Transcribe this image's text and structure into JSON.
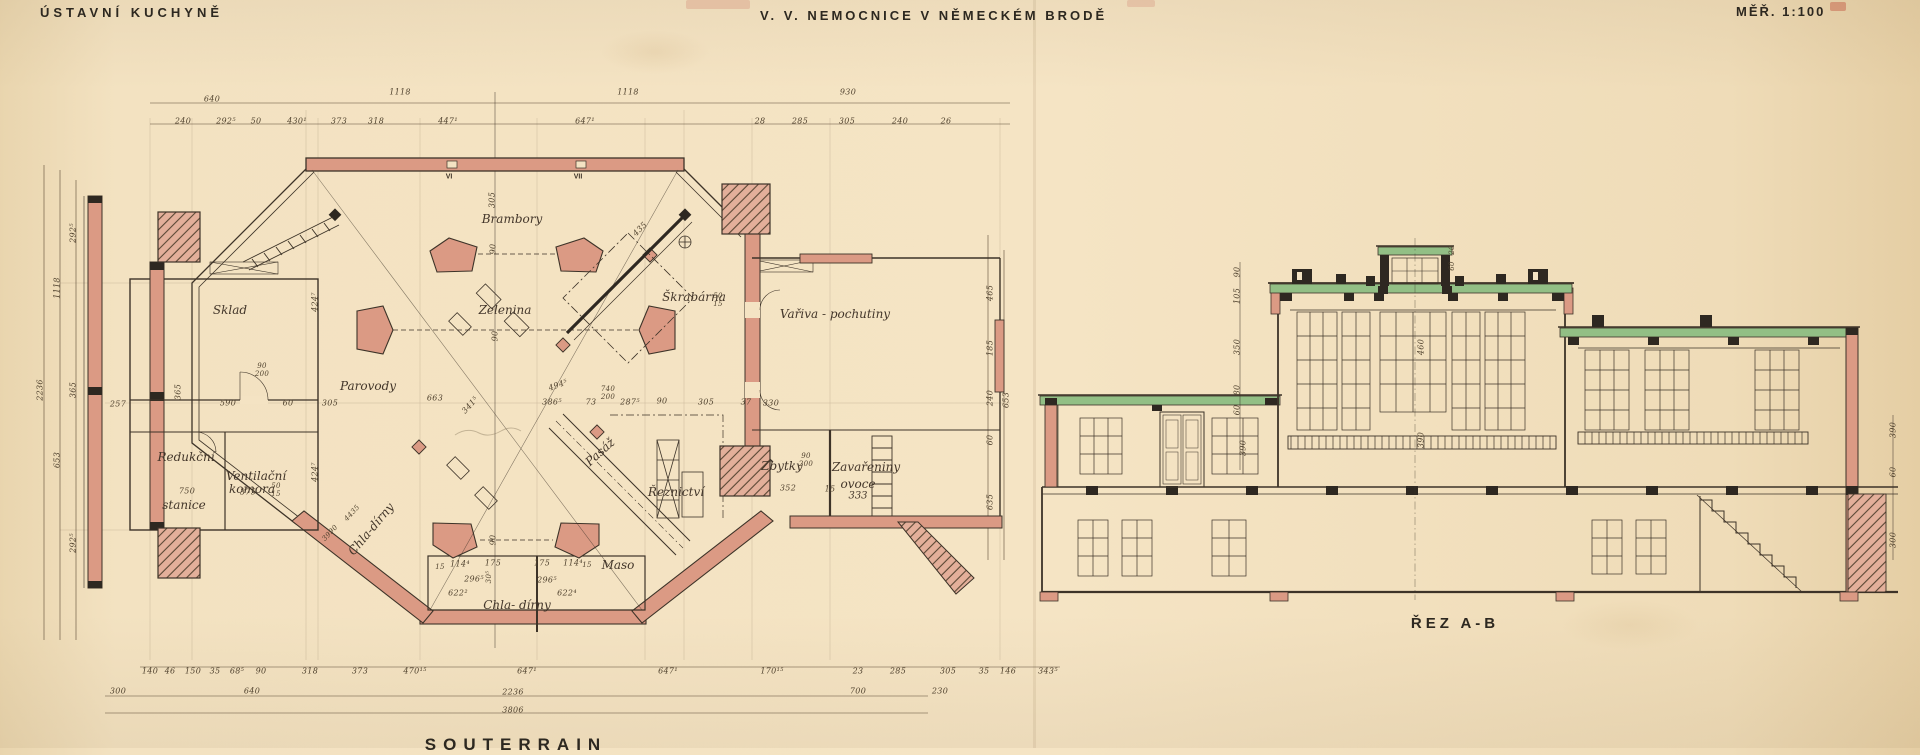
{
  "titles": {
    "left": "ÚSTAVNÍ KUCHYNĚ",
    "center": "V. V. NEMOCNICE V NĚMECKÉM BRODĚ",
    "right": "MĚŘ. 1:100"
  },
  "plan": {
    "caption": "SOUTERRAIN",
    "room_labels": [
      {
        "t": "Brambory",
        "x": 512,
        "y": 219
      },
      {
        "t": "Sklad",
        "x": 230,
        "y": 310
      },
      {
        "t": "Zelenina",
        "x": 505,
        "y": 310
      },
      {
        "t": "Škrabárna",
        "x": 694,
        "y": 297
      },
      {
        "t": "Vařiva - pochutiny",
        "x": 835,
        "y": 314
      },
      {
        "t": "Parovody",
        "x": 368,
        "y": 386
      },
      {
        "t": "Redukční",
        "x": 186,
        "y": 457
      },
      {
        "t": "stanice",
        "x": 184,
        "y": 505
      },
      {
        "t": "Ventilační",
        "x": 256,
        "y": 476
      },
      {
        "t": "komora",
        "x": 252,
        "y": 489
      },
      {
        "t": "Pasáž",
        "x": 600,
        "y": 452,
        "r": -42
      },
      {
        "t": "Řeznictví",
        "x": 676,
        "y": 492
      },
      {
        "t": "Zbytky",
        "x": 782,
        "y": 466
      },
      {
        "t": "Zavařeniny",
        "x": 866,
        "y": 467
      },
      {
        "t": "ovoce",
        "x": 858,
        "y": 484
      },
      {
        "t": "333",
        "x": 858,
        "y": 496,
        "s": 10
      },
      {
        "t": "Maso",
        "x": 618,
        "y": 565
      },
      {
        "t": "Chla- dírny",
        "x": 517,
        "y": 605
      },
      {
        "t": "Chla-dírny",
        "x": 371,
        "y": 529,
        "r": -50
      }
    ],
    "roman_labels": [
      {
        "t": "VI",
        "x": 449,
        "y": 177
      },
      {
        "t": "VII",
        "x": 578,
        "y": 177
      }
    ],
    "dim_labels": [
      {
        "t": "640",
        "x": 212,
        "y": 99
      },
      {
        "t": "1118",
        "x": 400,
        "y": 92
      },
      {
        "t": "1118",
        "x": 628,
        "y": 92
      },
      {
        "t": "930",
        "x": 848,
        "y": 92
      },
      {
        "t": "240",
        "x": 183,
        "y": 121
      },
      {
        "t": "292⁵",
        "x": 226,
        "y": 121
      },
      {
        "t": "50",
        "x": 256,
        "y": 121
      },
      {
        "t": "430¹",
        "x": 297,
        "y": 121
      },
      {
        "t": "373",
        "x": 339,
        "y": 121
      },
      {
        "t": "318",
        "x": 376,
        "y": 121
      },
      {
        "t": "447¹",
        "x": 448,
        "y": 121
      },
      {
        "t": "647¹",
        "x": 585,
        "y": 121
      },
      {
        "t": "28",
        "x": 760,
        "y": 121
      },
      {
        "t": "285",
        "x": 800,
        "y": 121
      },
      {
        "t": "305",
        "x": 847,
        "y": 121
      },
      {
        "t": "240",
        "x": 900,
        "y": 121
      },
      {
        "t": "26",
        "x": 946,
        "y": 121
      },
      {
        "t": "140",
        "x": 150,
        "y": 671
      },
      {
        "t": "46",
        "x": 170,
        "y": 671
      },
      {
        "t": "150",
        "x": 193,
        "y": 671
      },
      {
        "t": "35",
        "x": 215,
        "y": 671
      },
      {
        "t": "68⁵",
        "x": 237,
        "y": 671
      },
      {
        "t": "90",
        "x": 261,
        "y": 671
      },
      {
        "t": "318",
        "x": 310,
        "y": 671
      },
      {
        "t": "373",
        "x": 360,
        "y": 671
      },
      {
        "t": "470¹⁵",
        "x": 415,
        "y": 671
      },
      {
        "t": "647¹",
        "x": 527,
        "y": 671
      },
      {
        "t": "647¹",
        "x": 668,
        "y": 671
      },
      {
        "t": "170¹⁵",
        "x": 772,
        "y": 671
      },
      {
        "t": "23",
        "x": 858,
        "y": 671
      },
      {
        "t": "285",
        "x": 898,
        "y": 671
      },
      {
        "t": "305",
        "x": 948,
        "y": 671
      },
      {
        "t": "35",
        "x": 984,
        "y": 671
      },
      {
        "t": "146",
        "x": 1008,
        "y": 671
      },
      {
        "t": "343⁵",
        "x": 1048,
        "y": 671
      },
      {
        "t": "300",
        "x": 118,
        "y": 691
      },
      {
        "t": "640",
        "x": 252,
        "y": 691
      },
      {
        "t": "2236",
        "x": 513,
        "y": 692
      },
      {
        "t": "700",
        "x": 858,
        "y": 691
      },
      {
        "t": "230",
        "x": 940,
        "y": 691
      },
      {
        "t": "3806",
        "x": 513,
        "y": 710
      },
      {
        "t": "2236",
        "x": 40,
        "y": 390,
        "r": -90
      },
      {
        "t": "1118",
        "x": 57,
        "y": 288,
        "r": -90
      },
      {
        "t": "653",
        "x": 57,
        "y": 460,
        "r": -90
      },
      {
        "t": "292⁵",
        "x": 73,
        "y": 233,
        "r": -90
      },
      {
        "t": "365",
        "x": 73,
        "y": 390,
        "r": -90
      },
      {
        "t": "292⁵",
        "x": 73,
        "y": 543,
        "r": -90
      },
      {
        "t": "465",
        "x": 990,
        "y": 293,
        "r": -90
      },
      {
        "t": "185",
        "x": 990,
        "y": 348,
        "r": -90
      },
      {
        "t": "240",
        "x": 990,
        "y": 398,
        "r": -90
      },
      {
        "t": "60",
        "x": 990,
        "y": 440,
        "r": -90
      },
      {
        "t": "635",
        "x": 990,
        "y": 502,
        "r": -90
      },
      {
        "t": "653",
        "x": 1006,
        "y": 400,
        "r": -90
      },
      {
        "t": "424⁷",
        "x": 315,
        "y": 302,
        "r": -90
      },
      {
        "t": "424⁷",
        "x": 315,
        "y": 472,
        "r": -90
      },
      {
        "t": "435",
        "x": 640,
        "y": 229,
        "r": -45
      },
      {
        "t": "305",
        "x": 492,
        "y": 200,
        "r": -90
      },
      {
        "t": "90",
        "x": 493,
        "y": 249,
        "r": -90
      },
      {
        "t": "90",
        "x": 495,
        "y": 336,
        "r": -90
      },
      {
        "t": "663",
        "x": 435,
        "y": 398
      },
      {
        "t": "341⁵",
        "x": 470,
        "y": 405,
        "r": -48
      },
      {
        "t": "494⁵",
        "x": 558,
        "y": 385,
        "r": -20
      },
      {
        "t": "386⁵",
        "x": 552,
        "y": 402
      },
      {
        "t": "73",
        "x": 591,
        "y": 402
      },
      {
        "t": "740",
        "x": 608,
        "y": 389,
        "s": 7
      },
      {
        "t": "200",
        "x": 608,
        "y": 397,
        "s": 7
      },
      {
        "t": "287⁵",
        "x": 630,
        "y": 402
      },
      {
        "t": "90",
        "x": 662,
        "y": 401
      },
      {
        "t": "305",
        "x": 706,
        "y": 402
      },
      {
        "t": "37",
        "x": 746,
        "y": 402
      },
      {
        "t": "330",
        "x": 771,
        "y": 403
      },
      {
        "t": "352",
        "x": 788,
        "y": 488
      },
      {
        "t": "15",
        "x": 830,
        "y": 489
      },
      {
        "t": "90",
        "x": 806,
        "y": 456,
        "s": 7
      },
      {
        "t": "200",
        "x": 806,
        "y": 464,
        "s": 7
      },
      {
        "t": "90",
        "x": 262,
        "y": 366,
        "s": 7
      },
      {
        "t": "200",
        "x": 262,
        "y": 374,
        "s": 7
      },
      {
        "t": "590",
        "x": 228,
        "y": 403
      },
      {
        "t": "60",
        "x": 288,
        "y": 403
      },
      {
        "t": "305",
        "x": 330,
        "y": 403
      },
      {
        "t": "257",
        "x": 118,
        "y": 404
      },
      {
        "t": "365",
        "x": 178,
        "y": 392,
        "r": -90
      },
      {
        "t": "750",
        "x": 187,
        "y": 491
      },
      {
        "t": "375",
        "x": 248,
        "y": 492
      },
      {
        "t": "50",
        "x": 276,
        "y": 486,
        "s": 7
      },
      {
        "t": "15",
        "x": 276,
        "y": 494,
        "s": 7
      },
      {
        "t": "50",
        "x": 718,
        "y": 296,
        "s": 7
      },
      {
        "t": "15",
        "x": 718,
        "y": 304,
        "s": 7
      },
      {
        "t": "114⁴",
        "x": 460,
        "y": 564
      },
      {
        "t": "175",
        "x": 493,
        "y": 563
      },
      {
        "t": "175",
        "x": 542,
        "y": 563
      },
      {
        "t": "114⁴",
        "x": 573,
        "y": 563
      },
      {
        "t": "15",
        "x": 440,
        "y": 567,
        "s": 7
      },
      {
        "t": "15",
        "x": 587,
        "y": 565,
        "s": 7
      },
      {
        "t": "296⁵",
        "x": 474,
        "y": 579
      },
      {
        "t": "296⁵",
        "x": 547,
        "y": 580
      },
      {
        "t": "622²",
        "x": 458,
        "y": 593
      },
      {
        "t": "622⁴",
        "x": 567,
        "y": 593
      },
      {
        "t": "90",
        "x": 493,
        "y": 540,
        "r": -90
      },
      {
        "t": "30⁵",
        "x": 489,
        "y": 577,
        "r": -90,
        "s": 7
      },
      {
        "t": "3990",
        "x": 330,
        "y": 533,
        "r": -47,
        "s": 7
      },
      {
        "t": "4435",
        "x": 352,
        "y": 513,
        "r": -47,
        "s": 7
      }
    ]
  },
  "section": {
    "caption": "ŘEZ A-B",
    "dim_labels": [
      {
        "t": "90",
        "x": 1237,
        "y": 272,
        "r": -90
      },
      {
        "t": "105",
        "x": 1237,
        "y": 296,
        "r": -90
      },
      {
        "t": "350",
        "x": 1237,
        "y": 347,
        "r": -90
      },
      {
        "t": "80",
        "x": 1237,
        "y": 390,
        "r": -90
      },
      {
        "t": "60",
        "x": 1237,
        "y": 410,
        "r": -90
      },
      {
        "t": "390",
        "x": 1243,
        "y": 448,
        "r": -90
      },
      {
        "t": "460",
        "x": 1421,
        "y": 347,
        "r": -90
      },
      {
        "t": "390",
        "x": 1421,
        "y": 440,
        "r": -90
      },
      {
        "t": "20",
        "x": 1452,
        "y": 250,
        "r": -90,
        "s": 7
      },
      {
        "t": "60",
        "x": 1452,
        "y": 266,
        "r": -90,
        "s": 7
      },
      {
        "t": "390",
        "x": 1893,
        "y": 430,
        "r": -90
      },
      {
        "t": "60",
        "x": 1893,
        "y": 472,
        "r": -90
      },
      {
        "t": "300",
        "x": 1893,
        "y": 540,
        "r": -90
      }
    ]
  },
  "colors": {
    "paper": "#f4e3c3",
    "ink": "#3d3328",
    "wall_pink": "#db9a84",
    "roof_green": "#92bf85"
  }
}
